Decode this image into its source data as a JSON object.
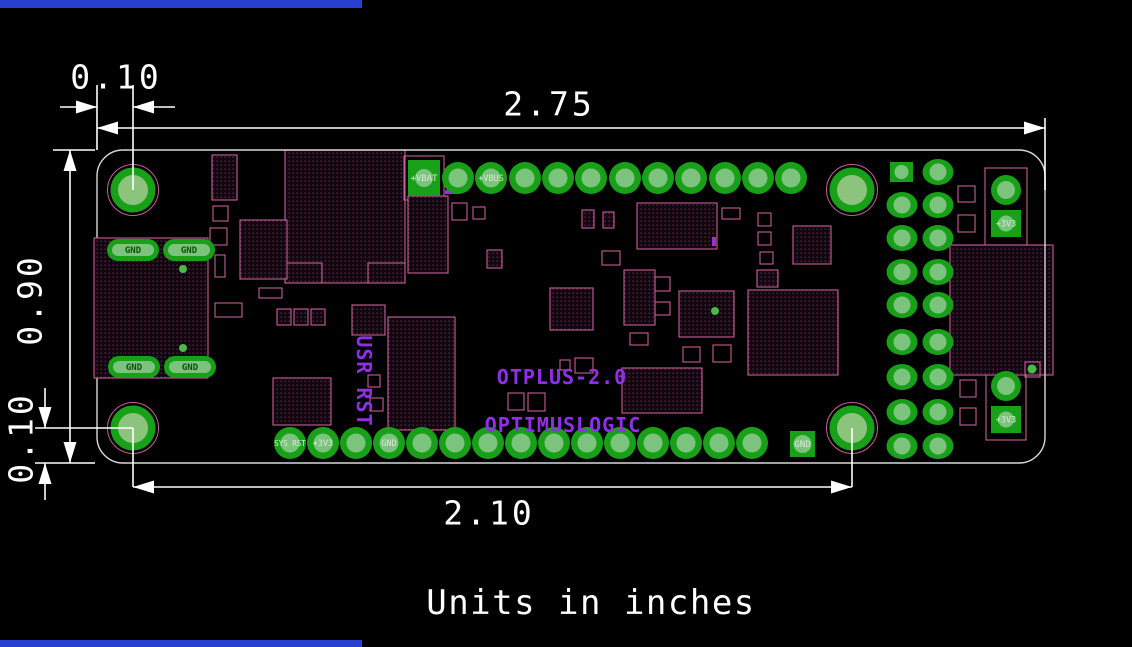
{
  "notes": {
    "units": "Units in inches"
  },
  "silkscreen": {
    "product": "OTPLUS-2.0",
    "brand": "OPTIMUSLOGIC",
    "user_reset": "USR RST"
  },
  "dimensions": [
    {
      "id": "left-edge-to-hole",
      "value": "0.10"
    },
    {
      "id": "board-width",
      "value": "2.75"
    },
    {
      "id": "board-height",
      "value": "0.90"
    },
    {
      "id": "hole-to-bottom-edge",
      "value": "0.10"
    },
    {
      "id": "hole-span",
      "value": "2.10"
    }
  ],
  "colors": {
    "background": "#000000",
    "dimension": "#ffffff",
    "board_edge": "#d8d8d8",
    "outline_pink": "#c45f95",
    "pad_green": "#18a018",
    "pad_core": "#7cc47e",
    "hole_core": "#8cc47e",
    "silk_purple": "#912fe8",
    "dot_green": "#49bb49",
    "accent_blue": "#2840cf",
    "dark_label_green": "#0a4f0a",
    "light_label": "#d9ead9"
  },
  "board": {
    "outline": {
      "x": 97,
      "y": 150,
      "w": 948,
      "h": 313,
      "rx": 26
    },
    "holes": [
      [
        133,
        190
      ],
      [
        852,
        190
      ],
      [
        133,
        428
      ],
      [
        852,
        428
      ]
    ],
    "hole_style": {
      "ring_r": 25.5,
      "pad_r": 22.5,
      "core_r": 15
    },
    "footprints": [
      [
        285,
        150,
        120,
        133,
        1
      ],
      [
        285,
        263,
        37,
        20,
        1
      ],
      [
        368,
        263,
        37,
        20,
        1
      ],
      [
        212,
        155,
        25,
        45,
        1
      ],
      [
        213,
        206,
        15,
        15,
        0
      ],
      [
        210,
        228,
        17,
        17,
        0
      ],
      [
        215,
        255,
        10,
        22,
        0
      ],
      [
        240,
        220,
        47,
        59,
        1
      ],
      [
        259,
        288,
        23,
        10,
        0
      ],
      [
        215,
        303,
        27,
        14,
        0
      ],
      [
        277,
        309,
        14,
        16,
        1
      ],
      [
        294,
        309,
        14,
        16,
        1
      ],
      [
        311,
        309,
        14,
        16,
        1
      ],
      [
        352,
        305,
        33,
        30,
        1
      ],
      [
        404,
        156,
        40,
        44,
        0
      ],
      [
        408,
        196,
        40,
        77,
        1
      ],
      [
        452,
        203,
        15,
        17,
        0
      ],
      [
        473,
        207,
        12,
        12,
        0
      ],
      [
        487,
        250,
        15,
        18,
        1
      ],
      [
        550,
        288,
        43,
        42,
        1
      ],
      [
        637,
        203,
        80,
        46,
        1
      ],
      [
        582,
        210,
        12,
        18,
        1
      ],
      [
        603,
        212,
        11,
        16,
        1
      ],
      [
        722,
        208,
        18,
        11,
        0
      ],
      [
        758,
        213,
        13,
        13,
        0
      ],
      [
        602,
        251,
        18,
        14,
        0
      ],
      [
        758,
        232,
        13,
        13,
        0
      ],
      [
        760,
        252,
        13,
        12,
        0
      ],
      [
        757,
        270,
        21,
        17,
        1
      ],
      [
        624,
        270,
        31,
        55,
        1
      ],
      [
        655,
        277,
        15,
        14,
        0
      ],
      [
        655,
        302,
        15,
        13,
        0
      ],
      [
        679,
        291,
        55,
        46,
        1
      ],
      [
        630,
        333,
        18,
        12,
        0
      ],
      [
        683,
        347,
        17,
        15,
        0
      ],
      [
        713,
        345,
        18,
        17,
        0
      ],
      [
        622,
        368,
        80,
        45,
        1
      ],
      [
        748,
        290,
        90,
        85,
        1
      ],
      [
        388,
        317,
        67,
        113,
        1
      ],
      [
        368,
        375,
        12,
        12,
        0
      ],
      [
        370,
        398,
        13,
        13,
        0
      ],
      [
        273,
        378,
        58,
        47,
        1
      ],
      [
        508,
        393,
        16,
        17,
        0
      ],
      [
        528,
        393,
        17,
        18,
        0
      ],
      [
        560,
        360,
        10,
        10,
        0
      ],
      [
        575,
        358,
        18,
        15,
        0
      ],
      [
        793,
        226,
        38,
        38,
        1
      ],
      [
        958,
        186,
        17,
        16,
        0
      ],
      [
        958,
        215,
        17,
        17,
        0
      ],
      [
        960,
        380,
        16,
        17,
        0
      ],
      [
        960,
        408,
        16,
        17,
        0
      ],
      [
        985,
        168,
        42,
        77,
        0
      ],
      [
        986,
        364,
        40,
        76,
        0
      ],
      [
        950,
        245,
        103,
        130,
        1
      ],
      [
        1025,
        362,
        15,
        15,
        0
      ]
    ],
    "purple_marks": [
      [
        712,
        237,
        4,
        9
      ],
      [
        445,
        190,
        12,
        4
      ]
    ],
    "usb": {
      "body": [
        94,
        238,
        114,
        140
      ],
      "pads": [
        [
          107,
          239
        ],
        [
          163,
          239
        ],
        [
          108,
          356
        ],
        [
          164,
          356
        ]
      ],
      "pad_w": 52,
      "pad_h": 22,
      "label": "GND"
    },
    "top_row": {
      "cy": 178,
      "r": 16,
      "core": 9.5,
      "round_cx": [
        458,
        491,
        525,
        558,
        591,
        625,
        658,
        691,
        725,
        758,
        791
      ],
      "square": {
        "x": 408,
        "y": 160,
        "w": 32,
        "h": 36,
        "label": "+VBAT"
      },
      "labels": {
        "491": "+VBUS"
      }
    },
    "bottom_row": {
      "cy": 443,
      "r": 16,
      "core": 9.5,
      "round_cx": [
        290,
        323,
        356,
        389,
        422,
        455,
        488,
        521,
        554,
        587,
        620,
        653,
        686,
        719,
        752
      ],
      "square": {
        "x": 790,
        "y": 431,
        "w": 25,
        "h": 26,
        "label": "GND"
      },
      "labels": {
        "290": "SYS RST",
        "323": "+3V3",
        "389": "GND"
      }
    },
    "right_header": {
      "cols": [
        902,
        938
      ],
      "rows": [
        172,
        205,
        238,
        272,
        305,
        342,
        377,
        412,
        446
      ],
      "rx": 15.5,
      "ry": 13,
      "core": 8.5,
      "square": {
        "x": 890,
        "y": 162,
        "w": 23,
        "h": 20
      }
    },
    "right_power": {
      "squares": [
        {
          "x": 991,
          "y": 210,
          "w": 30,
          "h": 27,
          "label": "+3V3"
        },
        {
          "x": 991,
          "y": 406,
          "w": 30,
          "h": 27,
          "label": "+3V3"
        }
      ],
      "rounds": [
        [
          1006,
          190
        ],
        [
          1006,
          386
        ]
      ],
      "round_r": 15,
      "core": 9
    },
    "dots": [
      [
        183,
        269,
        4
      ],
      [
        183,
        348,
        4
      ],
      [
        1032,
        369,
        4.5
      ],
      [
        715,
        311,
        4
      ]
    ],
    "dim_lines": [
      [
        60,
        107,
        97,
        107
      ],
      [
        133,
        107,
        175,
        107
      ],
      [
        97,
        85,
        97,
        150
      ],
      [
        133,
        85,
        133,
        190
      ],
      [
        97,
        128,
        1045,
        128
      ],
      [
        1045,
        118,
        1045,
        190
      ],
      [
        70,
        150,
        70,
        463
      ],
      [
        53,
        150,
        95,
        150
      ],
      [
        35,
        463,
        95,
        463
      ],
      [
        45,
        388,
        45,
        428
      ],
      [
        45,
        500,
        45,
        463
      ],
      [
        35,
        428,
        133,
        428
      ],
      [
        133,
        428,
        133,
        487
      ],
      [
        852,
        428,
        852,
        487
      ],
      [
        133,
        487,
        852,
        487
      ]
    ],
    "arrows": [
      [
        97,
        107,
        "r"
      ],
      [
        133,
        107,
        "l"
      ],
      [
        97,
        128,
        "l"
      ],
      [
        1045,
        128,
        "r"
      ],
      [
        70,
        150,
        "u"
      ],
      [
        70,
        463,
        "d"
      ],
      [
        45,
        428,
        "d"
      ],
      [
        45,
        463,
        "u"
      ],
      [
        133,
        487,
        "l"
      ],
      [
        852,
        487,
        "r"
      ]
    ]
  }
}
